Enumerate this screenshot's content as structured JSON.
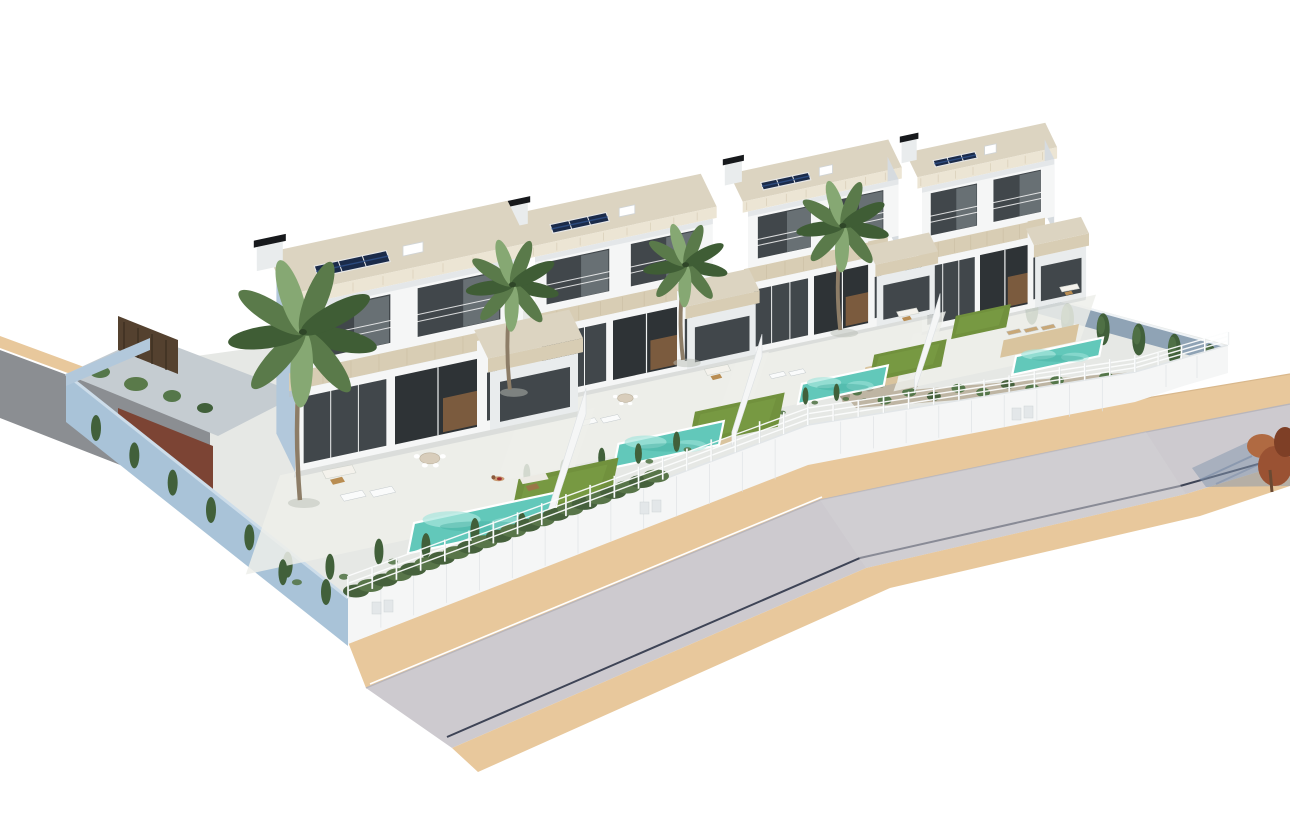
{
  "meta": {
    "type": "3d-architectural-render",
    "description": "Aerial 3D render of a row of four modern two-storey white villas with travertine bands, rooftop solar panels, chimneys, palm trees, private turquoise pools, lawns, white rail fences and a curving grey road with sand-coloured sidewalks on a white background",
    "background": "#ffffff"
  },
  "palette": {
    "bg": "#ffffff",
    "wall_lit": "#f5f6f6",
    "wall_shade": "#e9eced",
    "wall_deep": "#d6dbdf",
    "glass_dark": "#41474b",
    "glass_deep": "#2e3336",
    "interior_wood": "#7b5b3e",
    "travertine": "#d8cdb4",
    "travertine_dark": "#c3b596",
    "roof_edge": "#ece5d4",
    "roof_top": "#dcd4c1",
    "solar_navy": "#1b2b4a",
    "solar_cell": "#31528b",
    "chimney_black": "#17191c",
    "palm_dark": "#3f5d35",
    "palm_mid": "#5a7a4a",
    "palm_light": "#86a873",
    "trunk": "#8d7d67",
    "pool_water": "#62c8ba",
    "pool_light": "#a8e6dd",
    "pool_deep": "#46b0a2",
    "deck_tan": "#d9c49e",
    "lawn": "#71913d",
    "lawn_light": "#82a44c",
    "cypress": "#41603a",
    "bush": "#55774a",
    "gravel": "#beb5a3",
    "gravel_dark": "#a29a89",
    "blue_wall": "#a9c3d8",
    "blue_wall_light": "#cdddea",
    "blue_face": "#b2c8db",
    "inner_wall_blue": "#8fa3b5",
    "yard_floor": "#c5ccd1",
    "gate_brown": "#54412f",
    "road": "#cdcacf",
    "road_far": "#8b8e92",
    "road_line": "#3e4456",
    "sand": "#e8c89c",
    "sand_shade": "#d9b88c",
    "fence_white": "#fcfdfd",
    "fence_shadow": "#c9d0d4",
    "hedge": "#587549",
    "hedge_dark": "#46613c",
    "ground": "#e6e8e5",
    "terrace": "#edeeea",
    "shadow_blue": "#8496ae",
    "red_tree": "#9a5233",
    "red_tree_dark": "#7e3f26",
    "red_tree_light": "#b06a42",
    "skin": "#c99b72"
  },
  "scene": {
    "villa_count": 4,
    "villas": [
      {
        "id": "villa-4",
        "origin": [
          922,
          332
        ],
        "s": 0.58,
        "vs": 1.5,
        "side": "east",
        "solar": {
          "a": 28,
          "n": 16,
          "len": 72,
          "panels": 3
        },
        "chimney": {
          "a": -22,
          "n": 44
        },
        "palm": {
          "a": -148,
          "m": -44,
          "h": 120
        },
        "pool": {
          "a": 178,
          "m": 100,
          "len": 150,
          "w": 40
        },
        "deck": {
          "a": 150,
          "m": 58,
          "len": 130,
          "w": 38
        },
        "lawn": {
          "a": 55,
          "m": -20,
          "len": 95,
          "w": 50
        },
        "loungers": {
          "a": 152,
          "m": 40,
          "count": 3,
          "color": "tan"
        },
        "sofa": {
          "a": 232,
          "m": -34
        },
        "dining": null,
        "lawnsofa": null,
        "shrub_row": {
          "m": 128,
          "count": 0
        },
        "divider": false,
        "person": null
      },
      {
        "id": "villa-3",
        "origin": [
          748,
          354
        ],
        "s": 0.66,
        "vs": 1.3,
        "side": "east",
        "solar": {
          "a": 28,
          "n": 16,
          "len": 72,
          "panels": 3
        },
        "chimney": {
          "a": -22,
          "n": 44
        },
        "palm": {
          "a": -101,
          "m": -16,
          "h": 111
        },
        "pool": {
          "a": 95,
          "m": 82,
          "len": 130,
          "w": 38
        },
        "deck": {
          "a": 190,
          "m": 76,
          "len": 55,
          "w": 45
        },
        "lawn": {
          "a": 200,
          "m": 55,
          "len": 110,
          "w": 52
        },
        "loungers": {
          "a": 40,
          "m": 50,
          "count": 2,
          "color": "white"
        },
        "sofa": {
          "a": 222,
          "m": -20
        },
        "dining": null,
        "lawnsofa": null,
        "shrub_row": {
          "m": 118,
          "count": 4
        },
        "divider": true,
        "person": null
      },
      {
        "id": "villa-2",
        "origin": [
          535,
          402
        ],
        "s": 0.78,
        "vs": 1.12,
        "side": "none",
        "solar": {
          "a": 28,
          "n": 16,
          "len": 72,
          "panels": 3
        },
        "chimney": {
          "a": -22,
          "n": 44
        },
        "palm": {
          "a": -37,
          "m": -30,
          "h": 120
        },
        "pool": {
          "a": 123,
          "m": 100,
          "len": 135,
          "w": 38
        },
        "deck": {
          "a": 220,
          "m": 94,
          "len": 55,
          "w": 45
        },
        "lawn": {
          "a": 217,
          "m": 74,
          "len": 115,
          "w": 55
        },
        "loungers": {
          "a": 62,
          "m": 48,
          "count": 2,
          "color": "white"
        },
        "sofa": {
          "a": 218,
          "m": 6
        },
        "dining": {
          "a": 120,
          "m": 26
        },
        "lawnsofa": null,
        "shrub_row": {
          "m": 128,
          "count": 5
        },
        "divider": true,
        "person": null
      },
      {
        "id": "villa-1",
        "origin": [
          295,
          472
        ],
        "s": 1.0,
        "vs": 1.0,
        "side": "west",
        "solar": {
          "a": 28,
          "n": 16,
          "len": 72,
          "panels": 3
        },
        "chimney": {
          "a": -25,
          "n": 44
        },
        "palm": {
          "a": 11,
          "m": 38,
          "h": 168
        },
        "pool": {
          "a": 135,
          "m": 100,
          "len": 145,
          "w": 38
        },
        "deck": {
          "a": 238,
          "m": 92,
          "len": 58,
          "w": 48
        },
        "lawn": {
          "a": 235,
          "m": 72,
          "len": 100,
          "w": 50
        },
        "loungers": {
          "a": 52,
          "m": 43,
          "count": 2,
          "color": "white"
        },
        "sofa": {
          "a": 28,
          "m": 6
        },
        "dining": {
          "a": 138,
          "m": 20
        },
        "lawnsofa": {
          "a": 236,
          "m": 71
        },
        "shrub_row": {
          "m": 138,
          "count": 6
        },
        "divider": true,
        "person": {
          "a": 214,
          "m": 66
        }
      }
    ],
    "right_garden": {
      "cypress_count": 9,
      "bed_shrubs": 14,
      "gravel_patch": true
    },
    "front_boundary": {
      "rail_count": 3,
      "hedge": true,
      "meter_doors": 3
    },
    "roads": {
      "main_road": true,
      "upper_mini_road": true,
      "sidewalk_strips": 2
    },
    "accents": {
      "red_tree_at_right_edge": true,
      "tree_shadow_on_road": true
    }
  }
}
